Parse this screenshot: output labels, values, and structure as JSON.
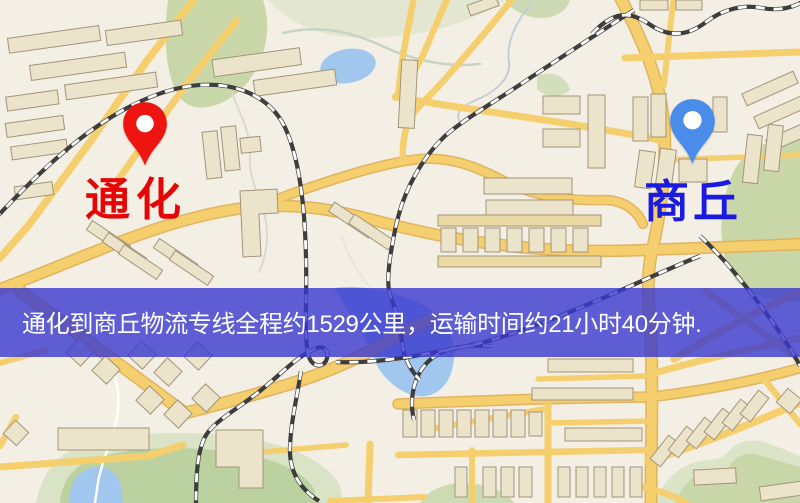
{
  "markers": {
    "origin": {
      "label": "通化",
      "pin_color": "#ee1511",
      "label_color": "#e60505"
    },
    "destination": {
      "label": "商丘",
      "pin_color": "#4a8cea",
      "label_color": "#1b1be0"
    }
  },
  "banner": {
    "text": "通化到商丘物流专线全程约1529公里，运输时间约21小时40分钟.",
    "background": "rgba(56,56,206,0.8)",
    "text_color": "#ffffff"
  }
}
